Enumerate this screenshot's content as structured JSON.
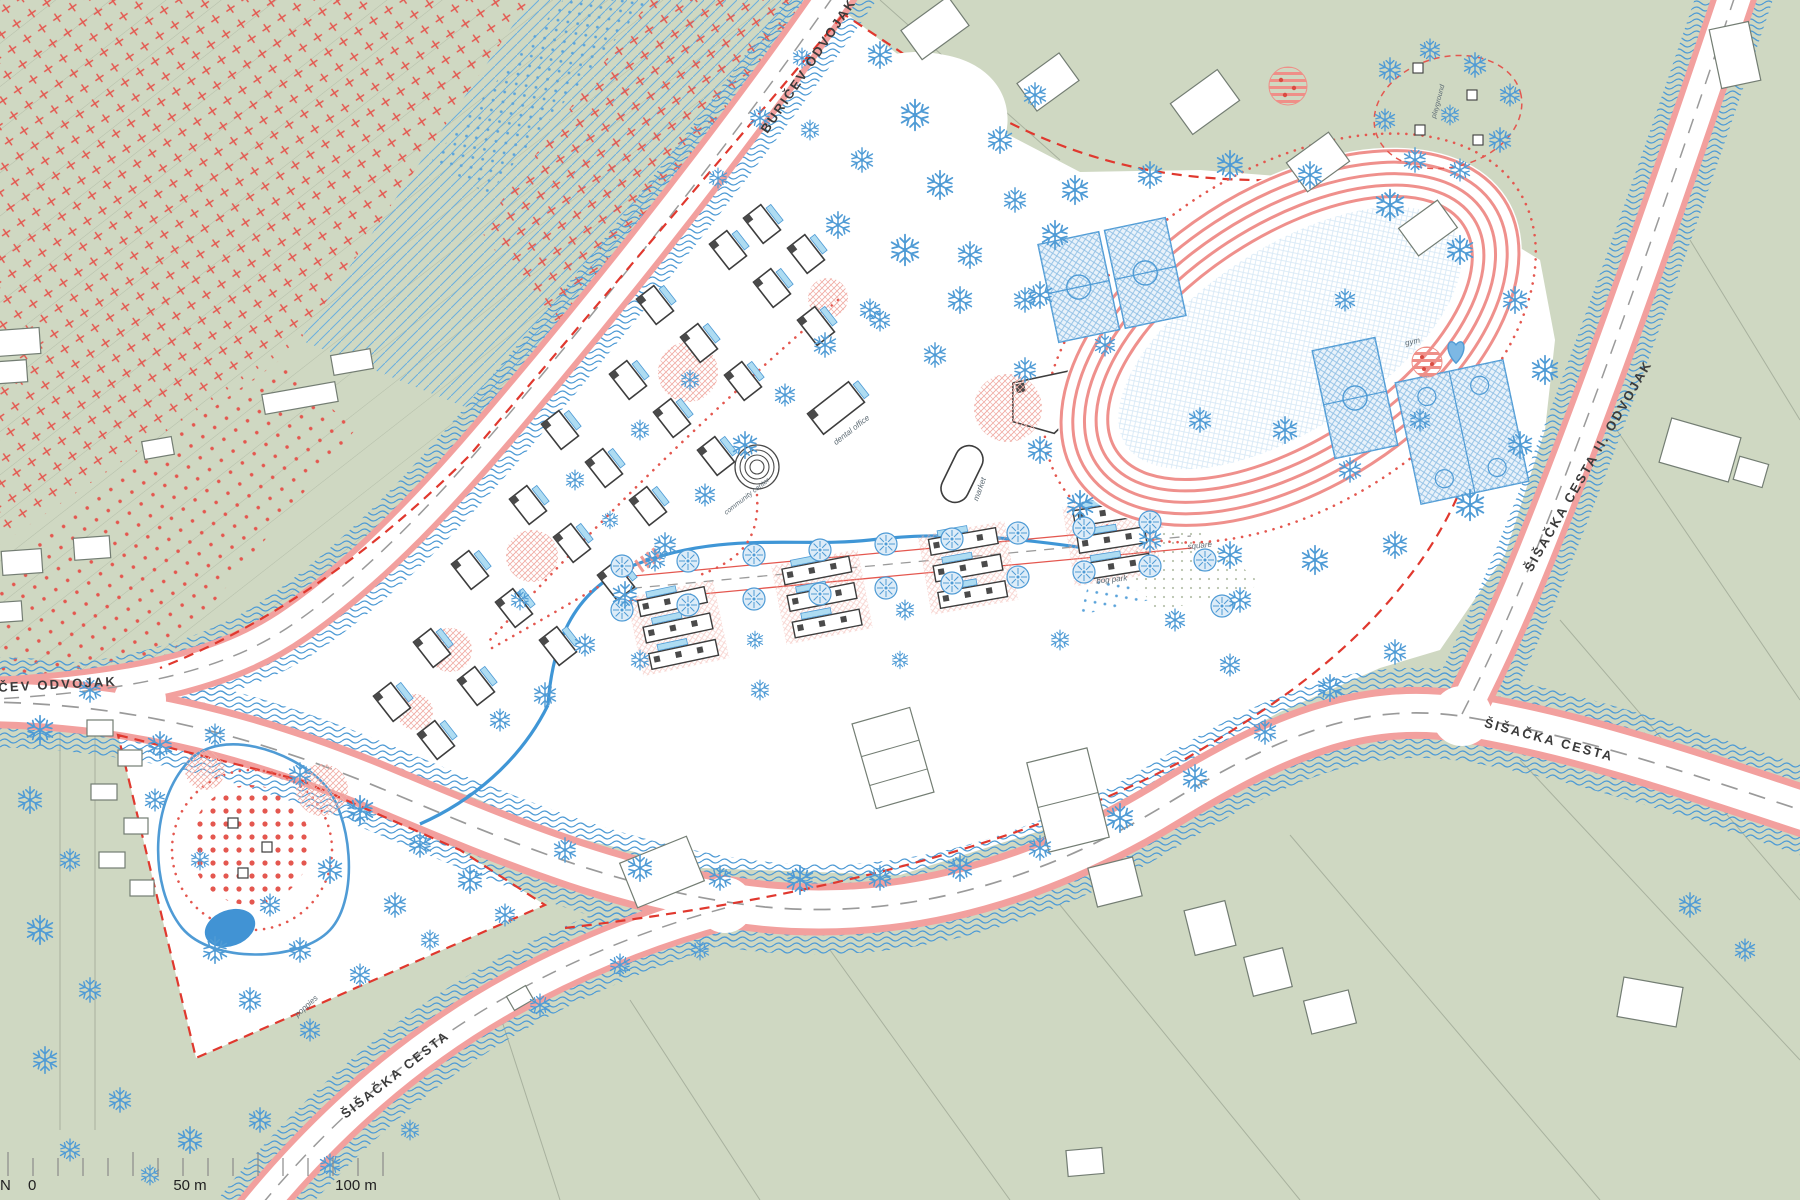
{
  "map": {
    "description": "Urban masterplan site plan of a residential neighbourhood with sports park",
    "roads": {
      "top": "BURIČEV ODVOJAK",
      "left": "BURIČEV ODVOJAK",
      "upper_right": "ŠIŠAČKA CESTA II. ODVOJAK",
      "lower_right": "ŠIŠAČKA CESTA",
      "bottom": "ŠIŠAČKA CESTA"
    },
    "places": {
      "dental_office": "dental office",
      "market": "market",
      "community_center": "community center",
      "square": "square",
      "sport": "sport",
      "gym": "gym",
      "bog_park": "bog park",
      "poppies": "poppies",
      "playground": "playground"
    },
    "scale": {
      "north": "N",
      "zero": "0",
      "fifty": "50 m",
      "hundred": "100 m"
    },
    "colors": {
      "background_green": "#cfd8c2",
      "site_white": "#ffffff",
      "road_edge_pink": "#f2a09e",
      "track_pink": "#ef908c",
      "water_blue": "#4f9bd5",
      "tree_blue": "#4f9bd5",
      "accent_red": "#e4574f",
      "boundary_red": "#e0382e",
      "court_blue": "#8fbfe4",
      "building_outline": "#3d3d3d",
      "parcel_gray": "#a8b19e"
    }
  }
}
